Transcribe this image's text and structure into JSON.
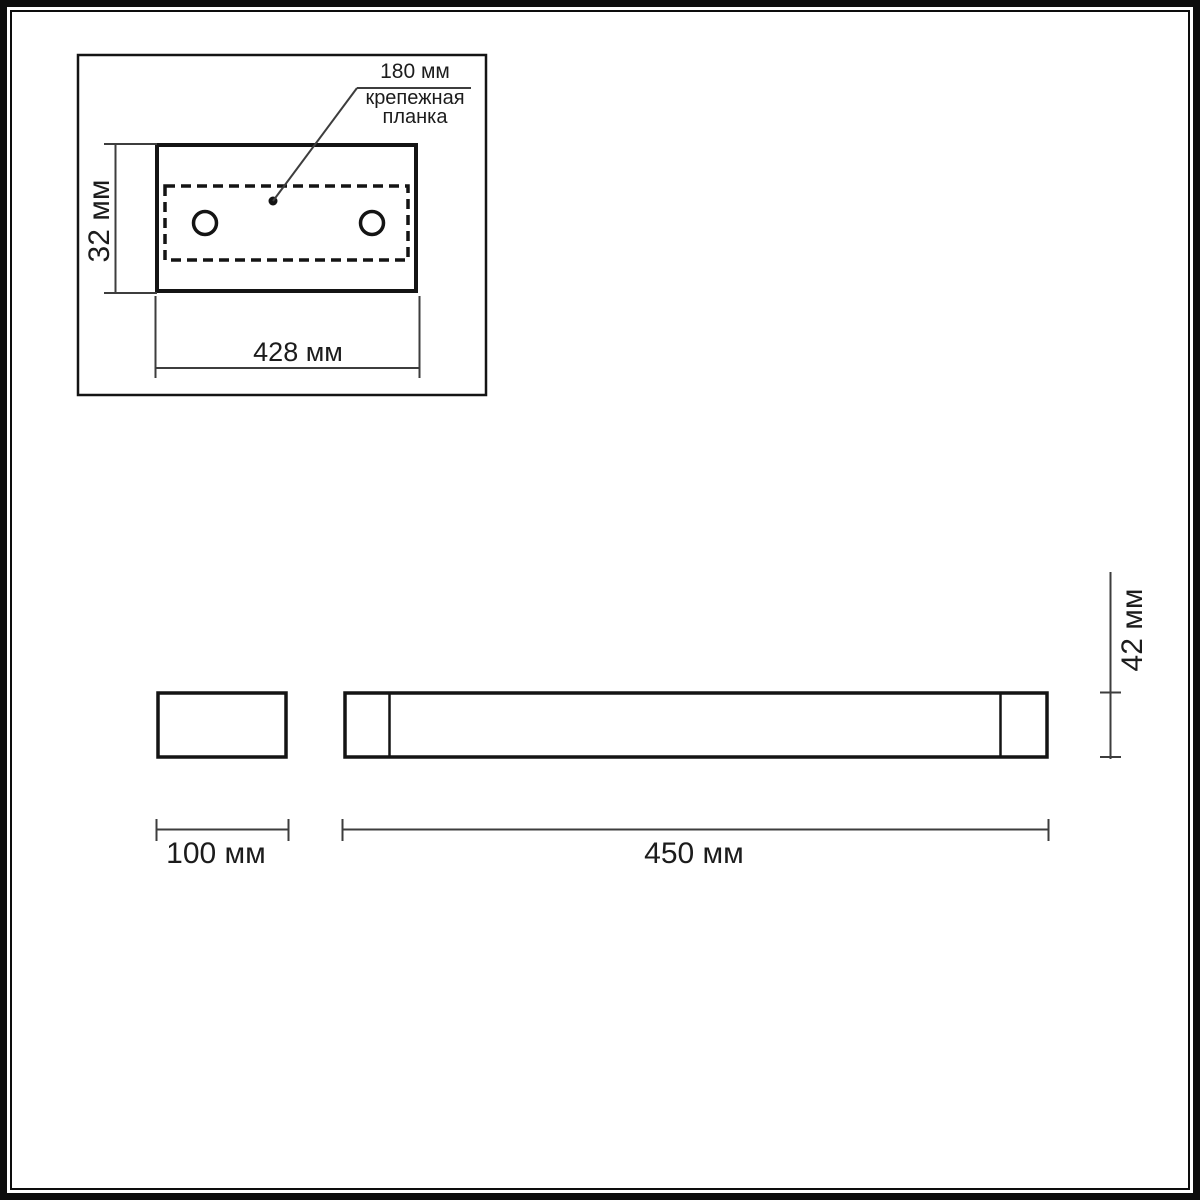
{
  "diagram": {
    "type": "product-dimension-drawing",
    "colors": {
      "background": "#ffffff",
      "shape_line": "#141414",
      "dimension_line": "#3d3d3d",
      "text": "#1c1c1c"
    },
    "top_view": {
      "mounting_width_label": "180 мм",
      "mounting_plate_label": "крепежная планка",
      "height_label": "32 мм",
      "width_label": "428 мм"
    },
    "side_view": {
      "depth_label": "100 мм",
      "length_label": "450 мм",
      "height_label": "42 мм"
    }
  }
}
